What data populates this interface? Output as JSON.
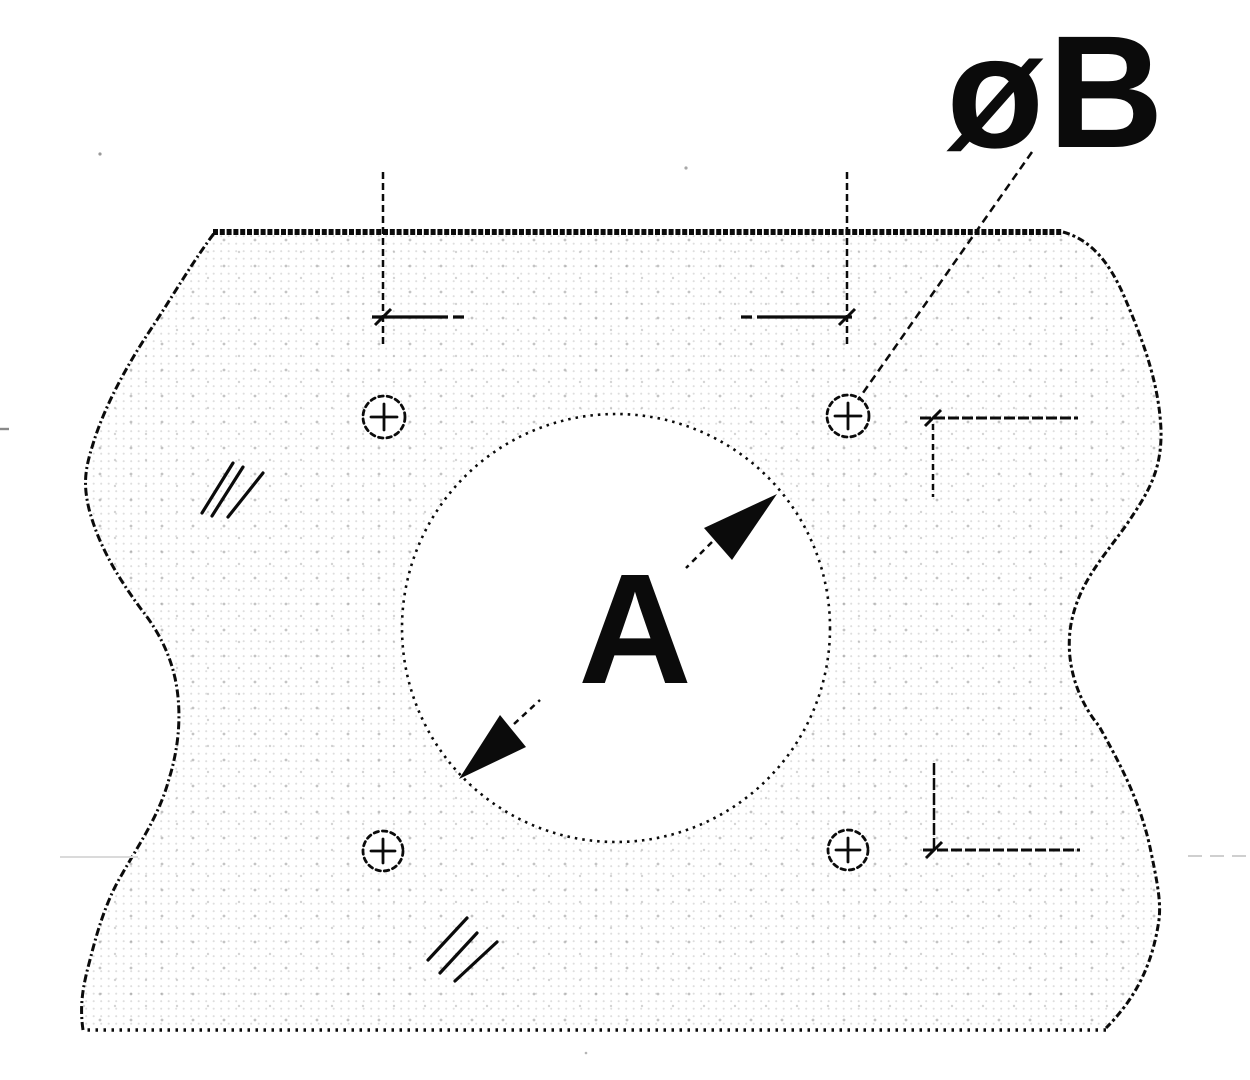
{
  "drawing": {
    "labels": {
      "center_hole_diameter": "A",
      "small_hole_diameter": "øB",
      "horizontal_hole_spacing": "C",
      "vertical_hole_spacing": "C"
    },
    "colors": {
      "ink": "#0b0b0b",
      "paper": "#ffffff"
    }
  }
}
